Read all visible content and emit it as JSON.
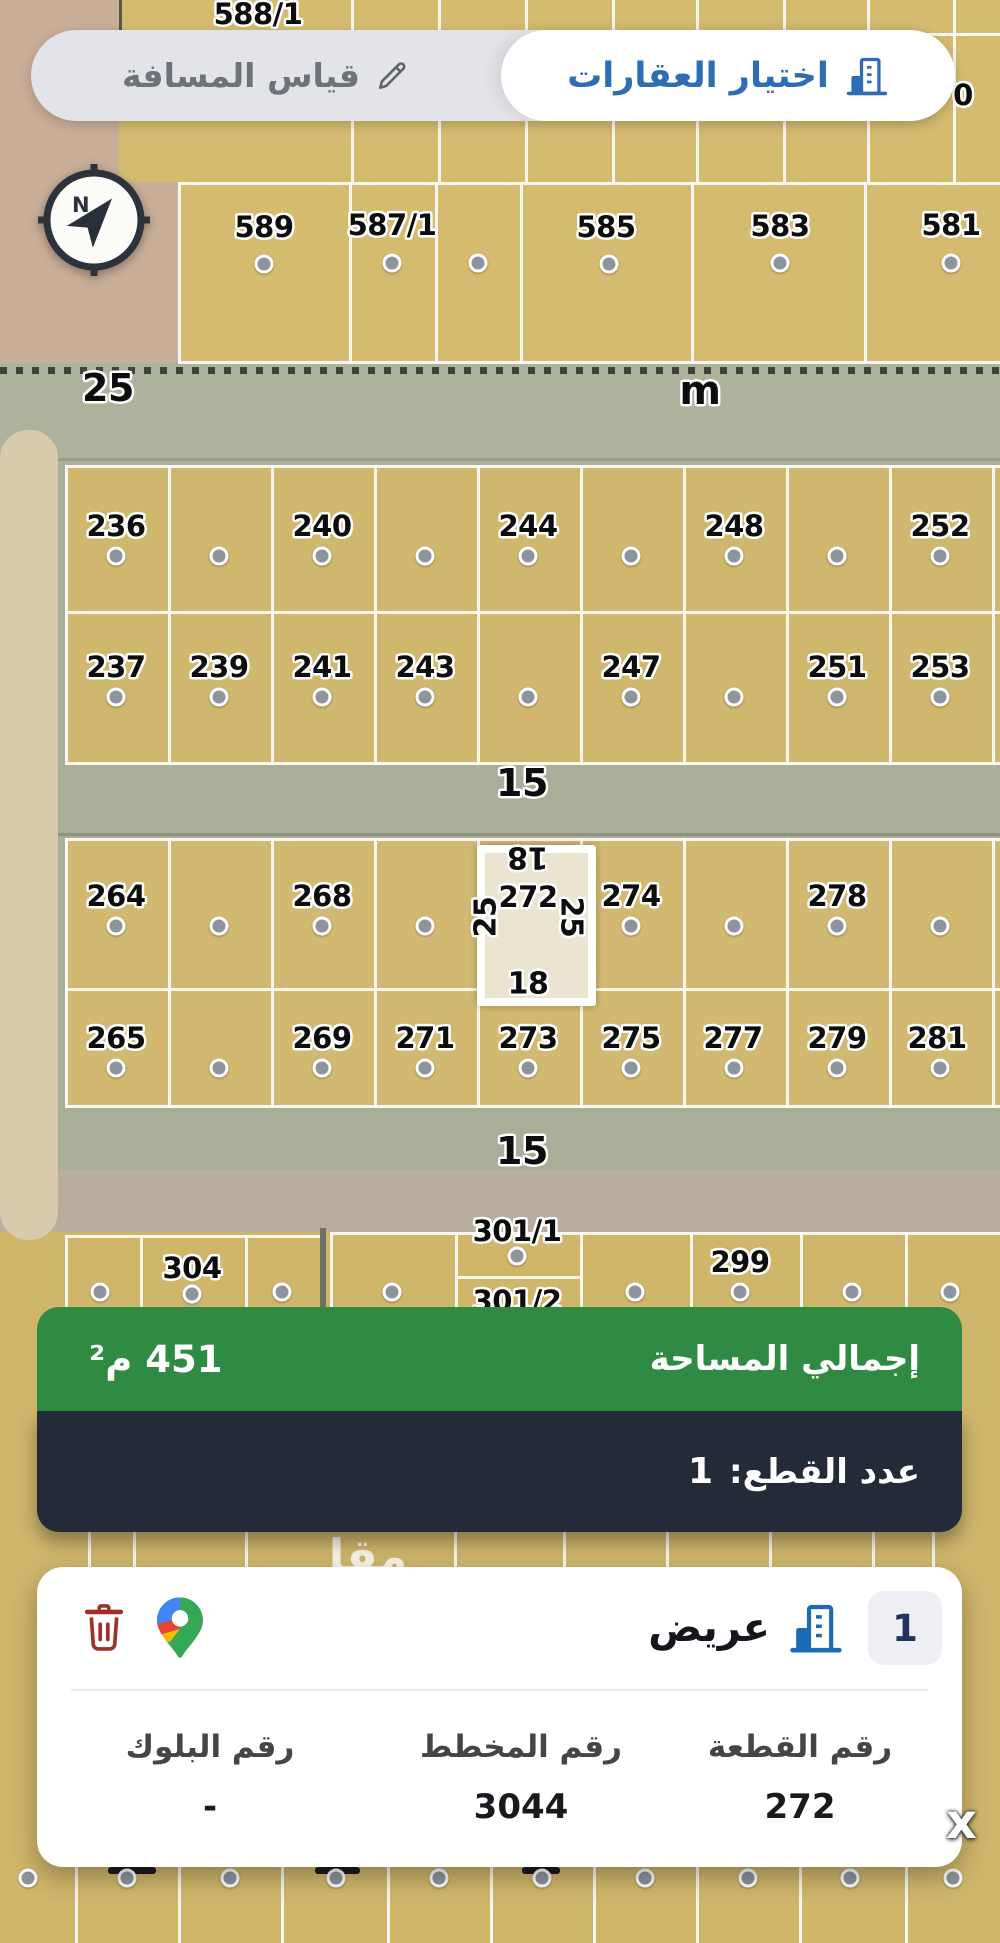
{
  "toolbar": {
    "measure_label": "قياس المسافة",
    "select_label": "اختيار العقارات"
  },
  "compass": {
    "north": "N"
  },
  "summary": {
    "area_label": "إجمالي المساحة",
    "area_value": "451 م²",
    "count_label": "عدد القطع:",
    "count_value": "1"
  },
  "parcel_card": {
    "index": "1",
    "name": "عريض",
    "fields": [
      {
        "label": "رقم القطعة",
        "value": "272",
        "cx": 763
      },
      {
        "label": "رقم المخطط",
        "value": "3044",
        "cx": 484
      },
      {
        "label": "رقم البلوك",
        "value": "-",
        "cx": 173
      }
    ]
  },
  "colors": {
    "accent_blue": "#2e6db4",
    "icon_blue": "#1d6ab5",
    "banner_green": "#2f8b43",
    "banner_dark": "#222b37",
    "parcel_tan": "#d1b86e",
    "road_gray_green": "#a9ae99",
    "selected_fill": "#eae4d1",
    "trash_red": "#9e3026",
    "badge_bg": "#edeff4",
    "pin_blue": "#4285F4",
    "pin_green": "#34A853",
    "pin_yellow": "#FBBC04",
    "pin_red": "#EA4335"
  },
  "map": {
    "watermark": {
      "t": "مقا"
    },
    "close": {
      "t": "x"
    },
    "rects": [
      {
        "x": 0,
        "y": 0,
        "w": 178,
        "h": 365,
        "c": "#c9ae98",
        "n": "terrain-rock"
      },
      {
        "x": 119,
        "y": 0,
        "w": 881,
        "h": 182,
        "c": "#d4bb70",
        "n": "parcel-block"
      },
      {
        "x": 119,
        "y": 0,
        "w": 3,
        "h": 34,
        "c": "#55584c",
        "n": "terrain-edge"
      },
      {
        "x": 178,
        "y": 182,
        "w": 822,
        "h": 181,
        "c": "#d4bb70",
        "n": "parcel-block"
      },
      {
        "x": 0,
        "y": 363,
        "w": 1000,
        "h": 102,
        "c": "#adb29d",
        "n": "road"
      },
      {
        "x": 0,
        "y": 367,
        "w": 1000,
        "h": 7,
        "c": "dots",
        "n": "road-dashed-line"
      },
      {
        "x": 0,
        "y": 458,
        "w": 1000,
        "h": 3,
        "c": "#999e8a",
        "n": "road-edge"
      },
      {
        "x": 65,
        "y": 465,
        "w": 935,
        "h": 300,
        "c": "#cfb76e",
        "n": "parcel-block"
      },
      {
        "x": 0,
        "y": 765,
        "w": 1000,
        "h": 73,
        "c": "#a9ae99",
        "n": "road"
      },
      {
        "x": 0,
        "y": 833,
        "w": 1000,
        "h": 3,
        "c": "#8e9380",
        "n": "road-edge"
      },
      {
        "x": 65,
        "y": 838,
        "w": 935,
        "h": 270,
        "c": "#d2b971",
        "n": "parcel-block"
      },
      {
        "x": 0,
        "y": 1108,
        "w": 1000,
        "h": 62,
        "c": "#a9ae99",
        "n": "road"
      },
      {
        "x": 0,
        "y": 1170,
        "w": 1000,
        "h": 62,
        "c": "#b9ae9d",
        "n": "road"
      },
      {
        "x": 0,
        "y": 1232,
        "w": 1000,
        "h": 711,
        "c": "#cfb66b",
        "n": "parcel-block"
      },
      {
        "x": 320,
        "y": 1228,
        "w": 6,
        "h": 80,
        "c": "#6f7262",
        "n": "road-edge"
      },
      {
        "x": 0,
        "y": 430,
        "w": 58,
        "h": 810,
        "c": "#d7cbab",
        "r": 28,
        "n": "terrain-wash"
      },
      {
        "x": 108,
        "y": 1867,
        "w": 48,
        "h": 7,
        "c": "#1c1c1c",
        "r": 3,
        "n": "clipped-parcel-label"
      },
      {
        "x": 315,
        "y": 1867,
        "w": 45,
        "h": 7,
        "c": "#1c1c1c",
        "r": 3,
        "n": "clipped-parcel-label"
      },
      {
        "x": 522,
        "y": 1867,
        "w": 38,
        "h": 7,
        "c": "#1c1c1c",
        "r": 3,
        "n": "clipped-parcel-label"
      }
    ],
    "vlines": [
      {
        "x": 351,
        "y": 0,
        "h": 182
      },
      {
        "x": 438,
        "y": 0,
        "h": 182
      },
      {
        "x": 525,
        "y": 0,
        "h": 182
      },
      {
        "x": 612,
        "y": 0,
        "h": 182
      },
      {
        "x": 696,
        "y": 0,
        "h": 182
      },
      {
        "x": 783,
        "y": 0,
        "h": 182
      },
      {
        "x": 867,
        "y": 0,
        "h": 182
      },
      {
        "x": 953,
        "y": 0,
        "h": 182
      },
      {
        "x": 178,
        "y": 182,
        "h": 181
      },
      {
        "x": 349,
        "y": 182,
        "h": 181
      },
      {
        "x": 435,
        "y": 182,
        "h": 181
      },
      {
        "x": 520,
        "y": 182,
        "h": 181
      },
      {
        "x": 691,
        "y": 182,
        "h": 181
      },
      {
        "x": 864,
        "y": 182,
        "h": 181
      },
      {
        "x": 65,
        "y": 465,
        "h": 300
      },
      {
        "x": 168,
        "y": 465,
        "h": 300
      },
      {
        "x": 271,
        "y": 465,
        "h": 300
      },
      {
        "x": 374,
        "y": 465,
        "h": 300
      },
      {
        "x": 477,
        "y": 465,
        "h": 300
      },
      {
        "x": 580,
        "y": 465,
        "h": 300
      },
      {
        "x": 683,
        "y": 465,
        "h": 300
      },
      {
        "x": 786,
        "y": 465,
        "h": 300
      },
      {
        "x": 889,
        "y": 465,
        "h": 300
      },
      {
        "x": 992,
        "y": 465,
        "h": 300
      },
      {
        "x": 65,
        "y": 838,
        "h": 270
      },
      {
        "x": 168,
        "y": 838,
        "h": 270
      },
      {
        "x": 271,
        "y": 838,
        "h": 270
      },
      {
        "x": 374,
        "y": 838,
        "h": 270
      },
      {
        "x": 477,
        "y": 838,
        "h": 270
      },
      {
        "x": 580,
        "y": 838,
        "h": 270
      },
      {
        "x": 683,
        "y": 838,
        "h": 270
      },
      {
        "x": 786,
        "y": 838,
        "h": 270
      },
      {
        "x": 889,
        "y": 838,
        "h": 270
      },
      {
        "x": 992,
        "y": 838,
        "h": 270
      },
      {
        "x": 65,
        "y": 1235,
        "h": 297
      },
      {
        "x": 140,
        "y": 1235,
        "h": 297
      },
      {
        "x": 245,
        "y": 1235,
        "h": 297
      },
      {
        "x": 330,
        "y": 1232,
        "h": 300
      },
      {
        "x": 455,
        "y": 1232,
        "h": 300
      },
      {
        "x": 580,
        "y": 1232,
        "h": 300
      },
      {
        "x": 690,
        "y": 1232,
        "h": 300
      },
      {
        "x": 800,
        "y": 1232,
        "h": 300
      },
      {
        "x": 905,
        "y": 1232,
        "h": 300
      },
      {
        "x": 88,
        "y": 1532,
        "h": 40
      },
      {
        "x": 133,
        "y": 1532,
        "h": 40
      },
      {
        "x": 245,
        "y": 1532,
        "h": 40
      },
      {
        "x": 454,
        "y": 1532,
        "h": 40
      },
      {
        "x": 563,
        "y": 1532,
        "h": 40
      },
      {
        "x": 666,
        "y": 1532,
        "h": 40
      },
      {
        "x": 769,
        "y": 1532,
        "h": 40
      },
      {
        "x": 872,
        "y": 1532,
        "h": 40
      },
      {
        "x": 932,
        "y": 1532,
        "h": 40
      },
      {
        "x": 75,
        "y": 1866,
        "h": 77
      },
      {
        "x": 178,
        "y": 1866,
        "h": 77
      },
      {
        "x": 281,
        "y": 1866,
        "h": 77
      },
      {
        "x": 387,
        "y": 1866,
        "h": 77
      },
      {
        "x": 490,
        "y": 1866,
        "h": 77
      },
      {
        "x": 593,
        "y": 1866,
        "h": 77
      },
      {
        "x": 696,
        "y": 1866,
        "h": 77
      },
      {
        "x": 799,
        "y": 1866,
        "h": 77
      },
      {
        "x": 905,
        "y": 1866,
        "h": 77
      }
    ],
    "hlines": [
      {
        "x": 119,
        "y": 33,
        "w": 881
      },
      {
        "x": 178,
        "y": 182,
        "w": 822
      },
      {
        "x": 178,
        "y": 361,
        "w": 822
      },
      {
        "x": 65,
        "y": 465,
        "w": 935
      },
      {
        "x": 65,
        "y": 611,
        "w": 935
      },
      {
        "x": 65,
        "y": 762,
        "w": 935
      },
      {
        "x": 65,
        "y": 838,
        "w": 935
      },
      {
        "x": 65,
        "y": 988,
        "w": 935
      },
      {
        "x": 65,
        "y": 1105,
        "w": 935
      },
      {
        "x": 65,
        "y": 1235,
        "w": 255
      },
      {
        "x": 330,
        "y": 1232,
        "w": 670
      },
      {
        "x": 455,
        "y": 1276,
        "w": 125
      }
    ],
    "dots": [
      [
        264,
        264
      ],
      [
        392,
        263
      ],
      [
        478,
        263
      ],
      [
        609,
        264
      ],
      [
        780,
        263
      ],
      [
        951,
        263
      ],
      [
        116,
        556
      ],
      [
        219,
        556
      ],
      [
        322,
        556
      ],
      [
        425,
        556
      ],
      [
        528,
        556
      ],
      [
        631,
        556
      ],
      [
        734,
        556
      ],
      [
        837,
        556
      ],
      [
        940,
        556
      ],
      [
        116,
        697
      ],
      [
        219,
        697
      ],
      [
        322,
        697
      ],
      [
        425,
        697
      ],
      [
        528,
        697
      ],
      [
        631,
        697
      ],
      [
        734,
        697
      ],
      [
        837,
        697
      ],
      [
        940,
        697
      ],
      [
        116,
        926
      ],
      [
        219,
        926
      ],
      [
        322,
        926
      ],
      [
        425,
        926
      ],
      [
        528,
        926
      ],
      [
        631,
        926
      ],
      [
        734,
        926
      ],
      [
        837,
        926
      ],
      [
        940,
        926
      ],
      [
        116,
        1068
      ],
      [
        219,
        1068
      ],
      [
        322,
        1068
      ],
      [
        425,
        1068
      ],
      [
        528,
        1068
      ],
      [
        631,
        1068
      ],
      [
        734,
        1068
      ],
      [
        837,
        1068
      ],
      [
        940,
        1068
      ],
      [
        100,
        1292
      ],
      [
        192,
        1294
      ],
      [
        282,
        1292
      ],
      [
        392,
        1292
      ],
      [
        517,
        1256
      ],
      [
        635,
        1292
      ],
      [
        740,
        1292
      ],
      [
        852,
        1292
      ],
      [
        950,
        1292
      ],
      [
        28,
        1878
      ],
      [
        127,
        1878
      ],
      [
        230,
        1878
      ],
      [
        336,
        1878
      ],
      [
        439,
        1878
      ],
      [
        542,
        1878
      ],
      [
        645,
        1878
      ],
      [
        748,
        1878
      ],
      [
        850,
        1878
      ],
      [
        953,
        1878
      ]
    ],
    "labels": [
      {
        "t": "588/1",
        "x": 258,
        "y": 14
      },
      {
        "t": "0",
        "x": 963,
        "y": 95
      },
      {
        "t": "589",
        "x": 264,
        "y": 227
      },
      {
        "t": "587/1",
        "x": 392,
        "y": 225
      },
      {
        "t": "585",
        "x": 606,
        "y": 227
      },
      {
        "t": "583",
        "x": 780,
        "y": 226
      },
      {
        "t": "581",
        "x": 951,
        "y": 225
      },
      {
        "t": "25",
        "x": 108,
        "y": 388,
        "s": 38,
        "n": "road-label"
      },
      {
        "t": "m",
        "x": 700,
        "y": 391,
        "s": 40,
        "n": "road-label"
      },
      {
        "t": "236",
        "x": 116,
        "y": 526
      },
      {
        "t": "240",
        "x": 322,
        "y": 526
      },
      {
        "t": "244",
        "x": 528,
        "y": 526
      },
      {
        "t": "248",
        "x": 734,
        "y": 526
      },
      {
        "t": "252",
        "x": 940,
        "y": 526
      },
      {
        "t": "237",
        "x": 116,
        "y": 667
      },
      {
        "t": "239",
        "x": 219,
        "y": 667
      },
      {
        "t": "241",
        "x": 322,
        "y": 667
      },
      {
        "t": "243",
        "x": 425,
        "y": 667
      },
      {
        "t": "247",
        "x": 631,
        "y": 667
      },
      {
        "t": "251",
        "x": 837,
        "y": 667
      },
      {
        "t": "253",
        "x": 940,
        "y": 667
      },
      {
        "t": "15",
        "x": 522,
        "y": 783,
        "s": 38,
        "n": "road-label"
      },
      {
        "t": "264",
        "x": 116,
        "y": 896
      },
      {
        "t": "268",
        "x": 322,
        "y": 896
      },
      {
        "t": "274",
        "x": 631,
        "y": 896
      },
      {
        "t": "278",
        "x": 837,
        "y": 896
      },
      {
        "t": "265",
        "x": 116,
        "y": 1038
      },
      {
        "t": "269",
        "x": 322,
        "y": 1038
      },
      {
        "t": "271",
        "x": 425,
        "y": 1038
      },
      {
        "t": "273",
        "x": 528,
        "y": 1038
      },
      {
        "t": "275",
        "x": 631,
        "y": 1038
      },
      {
        "t": "277",
        "x": 733,
        "y": 1038
      },
      {
        "t": "279",
        "x": 837,
        "y": 1038
      },
      {
        "t": "281",
        "x": 937,
        "y": 1038
      },
      {
        "t": "15",
        "x": 522,
        "y": 1151,
        "s": 38,
        "n": "road-label"
      },
      {
        "t": "304",
        "x": 192,
        "y": 1268
      },
      {
        "t": "301/1",
        "x": 517,
        "y": 1231
      },
      {
        "t": "301/2",
        "x": 517,
        "y": 1301
      },
      {
        "t": "299",
        "x": 740,
        "y": 1262
      }
    ],
    "selected": {
      "number": "272",
      "x": 477,
      "y": 845,
      "w": 103,
      "h": 145,
      "label": {
        "x": 528,
        "y": 897
      },
      "dims": [
        {
          "t": "18",
          "x": 528,
          "y": 857,
          "r": 180
        },
        {
          "t": "25",
          "x": 486,
          "y": 917,
          "r": -90
        },
        {
          "t": "25",
          "x": 571,
          "y": 917,
          "r": 90
        },
        {
          "t": "18",
          "x": 528,
          "y": 984,
          "r": 0
        }
      ]
    }
  }
}
